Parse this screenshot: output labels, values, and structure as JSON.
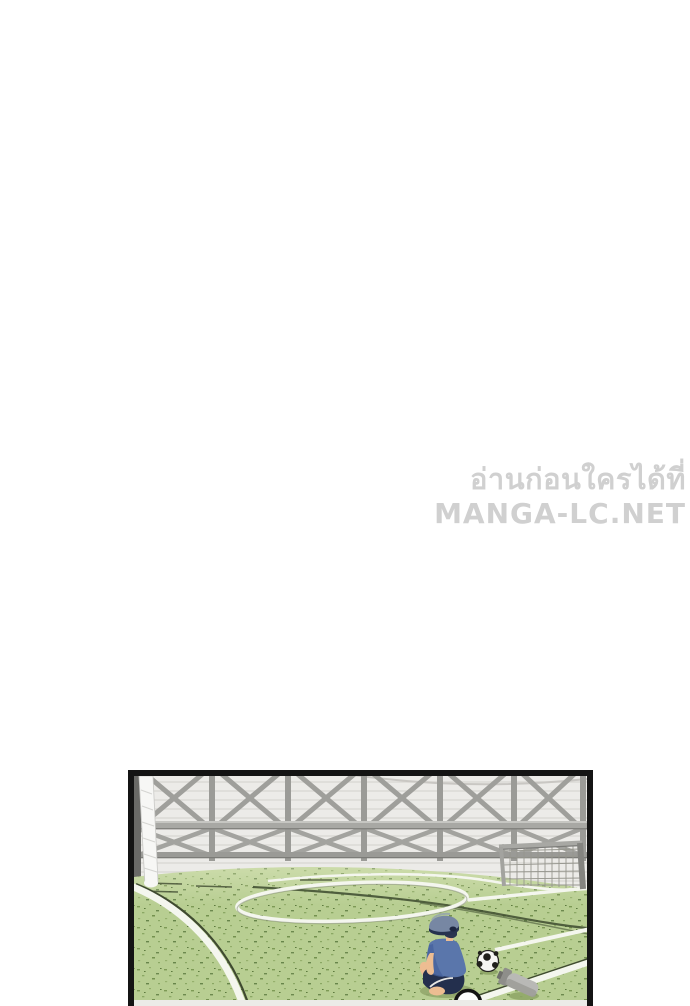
{
  "page": {
    "background_color": "#ffffff"
  },
  "watermark": {
    "line1": "อ่านก่อนใครได้ที่",
    "line2": "MANGA-LC.NET",
    "text_color": "#d0d0d0",
    "outline_color": "#ffffff"
  },
  "panel": {
    "type": "manga-panel",
    "scene": "Boy in a blue shirt and cap sitting alone on an indoor soccer field seen from behind, soccer ball and water bottle beside him, X-braced fence wall and small goal in the background",
    "border_color": "#141414",
    "colors": {
      "wall": "#ecebe8",
      "wall_line": "#dbd9d5",
      "fence": "#a2a29e",
      "fence_dark": "#8b8b87",
      "grass": "#b8ce92",
      "grass_speckle": "#7d9a55",
      "field_line": "#f4f6ee",
      "dark_line": "#3f4a30",
      "net_white": "#f7f7f5",
      "goal_gray": "#a8a8a4",
      "cap": "#7787a3",
      "cap_band": "#26324f",
      "shirt": "#5a76ab",
      "shirt_shade": "#46619c",
      "shorts": "#232f4d",
      "skin": "#edbd92",
      "ball": "#f5f5f3",
      "ball_spot": "#20201c",
      "bottle": "#b9b9b6",
      "shadow_green": "#93a96d"
    }
  }
}
